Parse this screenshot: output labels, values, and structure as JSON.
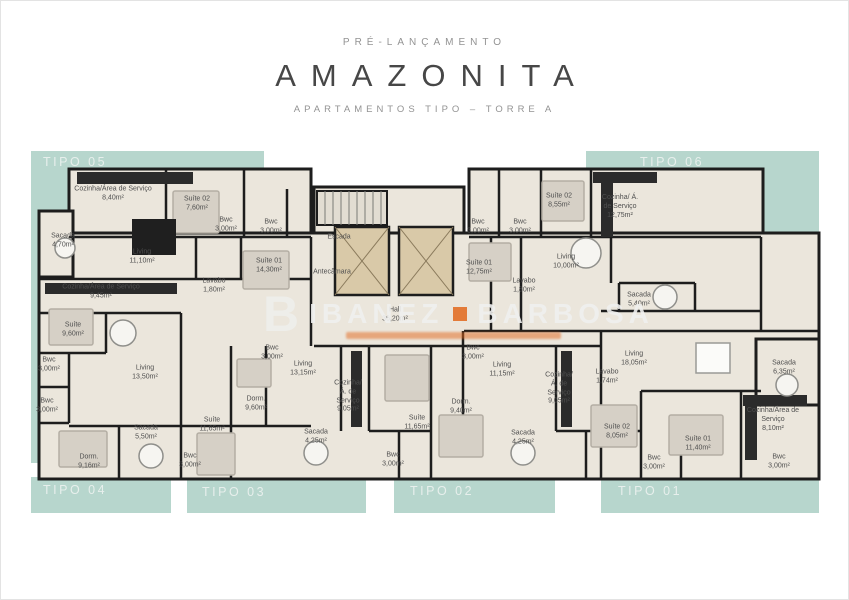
{
  "header": {
    "pre_title": "PRÉ-LANÇAMENTO",
    "title": "AMAZONITA",
    "subtitle": "APARTAMENTOS TIPO – TORRE A"
  },
  "watermark": {
    "initial": "B",
    "name_left": "IBANEZ",
    "name_right": "BARBOSA"
  },
  "colors": {
    "teal": "#b7d6cd",
    "floor": "#ebe6dc",
    "wall": "#1d1d1d",
    "room_text": "#4f4f4f",
    "tipo_text": "#e7efec",
    "header_gray": "#939393",
    "title_dark": "#474747",
    "accent_orange": "#e2671c",
    "furniture": "#d6d0c6",
    "furniture_edge": "#b4aea4",
    "counter": "#2b2b2b",
    "elevator": "#d9c9a8"
  },
  "unit_labels": [
    {
      "text": "TIPO 05",
      "x": 42,
      "y": 154
    },
    {
      "text": "TIPO 06",
      "x": 639,
      "y": 154
    },
    {
      "text": "TIPO 04",
      "x": 42,
      "y": 482
    },
    {
      "text": "TIPO 03",
      "x": 201,
      "y": 484
    },
    {
      "text": "TIPO 02",
      "x": 409,
      "y": 483
    },
    {
      "text": "TIPO 01",
      "x": 617,
      "y": 483
    }
  ],
  "rooms": [
    {
      "name": "Cozinha/Área de Serviço",
      "area": "8,40m²",
      "x": 112,
      "y": 193
    },
    {
      "name": "Suíte 02",
      "area": "7,60m²",
      "x": 196,
      "y": 203
    },
    {
      "name": "Bwc",
      "area": "3,00m²",
      "x": 225,
      "y": 224
    },
    {
      "name": "Bwc",
      "area": "3,00m²",
      "x": 270,
      "y": 226
    },
    {
      "name": "Sacada",
      "area": "4,70m²",
      "x": 62,
      "y": 240
    },
    {
      "name": "Living",
      "area": "11,10m²",
      "x": 141,
      "y": 256
    },
    {
      "name": "Suíte 01",
      "area": "14,30m²",
      "x": 268,
      "y": 265
    },
    {
      "name": "Lavabo",
      "area": "1,80m²",
      "x": 213,
      "y": 285
    },
    {
      "name": "Escada",
      "area": "",
      "x": 338,
      "y": 237
    },
    {
      "name": "Antecâmara",
      "area": "",
      "x": 331,
      "y": 272
    },
    {
      "name": "Hall",
      "area": "36,20m²",
      "x": 394,
      "y": 314
    },
    {
      "name": "Bwc",
      "area": "3,00m²",
      "x": 477,
      "y": 226
    },
    {
      "name": "Bwc",
      "area": "3,00m²",
      "x": 519,
      "y": 226
    },
    {
      "name": "Suíte 02",
      "area": "8,55m²",
      "x": 558,
      "y": 200
    },
    {
      "name": "Cozinha/ Á. de Serviço",
      "area": "12,75m²",
      "x": 619,
      "y": 206,
      "w": 38
    },
    {
      "name": "Suíte 01",
      "area": "12,75m²",
      "x": 478,
      "y": 267
    },
    {
      "name": "Living",
      "area": "10,00m²",
      "x": 565,
      "y": 261
    },
    {
      "name": "Lavabo",
      "area": "1,80m²",
      "x": 523,
      "y": 285
    },
    {
      "name": "Sacada",
      "area": "5,40m²",
      "x": 638,
      "y": 299
    },
    {
      "name": "Cozinha/Área de Serviço",
      "area": "9,45m²",
      "x": 100,
      "y": 291
    },
    {
      "name": "Suíte",
      "area": "9,60m²",
      "x": 72,
      "y": 329
    },
    {
      "name": "Bwc",
      "area": "3,00m²",
      "x": 48,
      "y": 364
    },
    {
      "name": "Bwc",
      "area": "3,00m²",
      "x": 46,
      "y": 405
    },
    {
      "name": "Living",
      "area": "13,50m²",
      "x": 144,
      "y": 372
    },
    {
      "name": "Dorm.",
      "area": "9,16m²",
      "x": 88,
      "y": 461
    },
    {
      "name": "Sacada",
      "area": "5,50m²",
      "x": 145,
      "y": 432
    },
    {
      "name": "Bwc",
      "area": "3,00m²",
      "x": 189,
      "y": 460
    },
    {
      "name": "Suíte",
      "area": "11,65m²",
      "x": 211,
      "y": 424
    },
    {
      "name": "Dorm.",
      "area": "9,60m²",
      "x": 255,
      "y": 403
    },
    {
      "name": "Bwc",
      "area": "3,00m²",
      "x": 271,
      "y": 352
    },
    {
      "name": "Living",
      "area": "13,15m²",
      "x": 302,
      "y": 368
    },
    {
      "name": "Sacada",
      "area": "4,25m²",
      "x": 315,
      "y": 436
    },
    {
      "name": "Cozinha/ Á. de Serviço",
      "area": "9,05m²",
      "x": 347,
      "y": 396,
      "w": 36
    },
    {
      "name": "Bwc",
      "area": "3,00m²",
      "x": 392,
      "y": 459
    },
    {
      "name": "Suíte",
      "area": "11,65m²",
      "x": 416,
      "y": 422
    },
    {
      "name": "Dorm.",
      "area": "9,40m²",
      "x": 460,
      "y": 406
    },
    {
      "name": "Bwc",
      "area": "3,00m²",
      "x": 472,
      "y": 352
    },
    {
      "name": "Living",
      "area": "11,15m²",
      "x": 501,
      "y": 369
    },
    {
      "name": "Sacada",
      "area": "4,25m²",
      "x": 522,
      "y": 437
    },
    {
      "name": "Cozinha/ Á. de Serviço",
      "area": "9,05m²",
      "x": 558,
      "y": 388,
      "w": 36
    },
    {
      "name": "Living",
      "area": "18,05m²",
      "x": 633,
      "y": 358
    },
    {
      "name": "Lavabo",
      "area": "1,74m²",
      "x": 606,
      "y": 376
    },
    {
      "name": "Suíte 02",
      "area": "8,05m²",
      "x": 616,
      "y": 431
    },
    {
      "name": "Bwc",
      "area": "3,00m²",
      "x": 653,
      "y": 462
    },
    {
      "name": "Suíte 01",
      "area": "11,40m²",
      "x": 697,
      "y": 443
    },
    {
      "name": "Cozinha/Área de Serviço",
      "area": "8,10m²",
      "x": 772,
      "y": 419,
      "w": 66
    },
    {
      "name": "Bwc",
      "area": "3,00m²",
      "x": 778,
      "y": 461
    },
    {
      "name": "Sacada",
      "area": "6,35m²",
      "x": 783,
      "y": 367
    }
  ]
}
